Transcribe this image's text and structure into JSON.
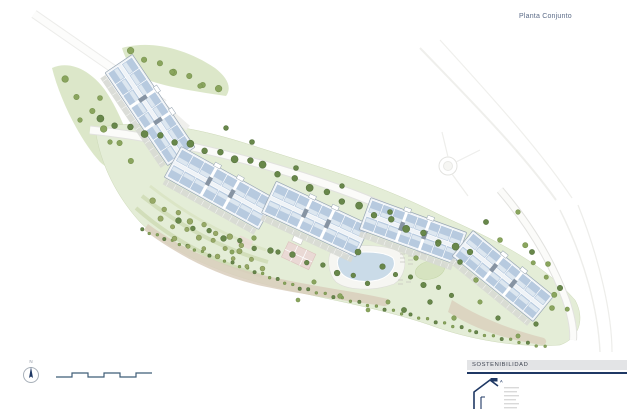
{
  "title": "Planta Conjunto",
  "north": {
    "label": "N"
  },
  "legend": {
    "sustainability": "SOSTENIBILIDAD"
  },
  "colors": {
    "title_text": "#5b6b87",
    "navy": "#1f3864",
    "green_light": "#e4edd7",
    "green_mid": "#d6e3c0",
    "tree_dark": "#68874a",
    "tree_mid": "#8aa55e",
    "tree_light": "#aebf85",
    "olive": "#97a966",
    "road_edge": "#e4e4e1",
    "road_fill": "#fcfcfb",
    "parking": "#d7d9d4",
    "building_base": "#eff3f7",
    "building_unit": "#b7cadf",
    "building_unit_light": "#dde7f0",
    "building_core": "#8794a3",
    "building_stroke": "#98a6b3",
    "pool": "#cadbe8",
    "deck": "#f6f6f2",
    "tan": "#d9cebc",
    "pink": "#ead9d5",
    "scalebar": "#3f5d77",
    "label_gray": "#8b93a0",
    "bar_bg": "#e3e4e6",
    "bar_text": "#3d4350"
  },
  "site_plan": {
    "blocks": [
      {
        "cx": 150,
        "cy": 110,
        "angle": 56,
        "len": 112,
        "wid": 33,
        "units": 8
      },
      {
        "cx": 220,
        "cy": 188,
        "angle": 29,
        "len": 108,
        "wid": 35,
        "units": 8
      },
      {
        "cx": 316,
        "cy": 219,
        "angle": 25,
        "len": 104,
        "wid": 35,
        "units": 8
      },
      {
        "cx": 413,
        "cy": 231,
        "angle": 20,
        "len": 102,
        "wid": 34,
        "units": 8
      },
      {
        "cx": 503,
        "cy": 276,
        "angle": 39,
        "len": 104,
        "wid": 33,
        "units": 8
      }
    ],
    "tree_rows": [
      {
        "x1": 100,
        "y1": 120,
        "x2": 250,
        "y2": 162,
        "n": 11,
        "r": 3.2,
        "color": "tree_dark"
      },
      {
        "x1": 262,
        "y1": 166,
        "x2": 455,
        "y2": 248,
        "n": 13,
        "r": 3.2,
        "color": "tree_dark"
      },
      {
        "x1": 64,
        "y1": 80,
        "x2": 132,
        "y2": 160,
        "n": 6,
        "r": 3,
        "color": "tree_mid"
      },
      {
        "x1": 130,
        "y1": 52,
        "x2": 218,
        "y2": 90,
        "n": 7,
        "r": 3,
        "color": "tree_mid"
      },
      {
        "x1": 142,
        "y1": 230,
        "x2": 300,
        "y2": 288,
        "n": 22,
        "r": 1.5,
        "color": "tree_mid"
      },
      {
        "x1": 308,
        "y1": 290,
        "x2": 470,
        "y2": 330,
        "n": 20,
        "r": 1.5,
        "color": "tree_mid"
      },
      {
        "x1": 476,
        "y1": 333,
        "x2": 545,
        "y2": 347,
        "n": 9,
        "r": 1.5,
        "color": "tree_mid"
      },
      {
        "x1": 152,
        "y1": 202,
        "x2": 242,
        "y2": 244,
        "n": 8,
        "r": 2.6,
        "color": "olive"
      },
      {
        "x1": 160,
        "y1": 220,
        "x2": 252,
        "y2": 258,
        "n": 8,
        "r": 2.4,
        "color": "olive"
      },
      {
        "x1": 174,
        "y1": 240,
        "x2": 262,
        "y2": 270,
        "n": 7,
        "r": 2.2,
        "color": "olive"
      },
      {
        "x1": 178,
        "y1": 222,
        "x2": 270,
        "y2": 252,
        "n": 7,
        "r": 2.6,
        "color": "tree_dark"
      },
      {
        "x1": 292,
        "y1": 256,
        "x2": 368,
        "y2": 282,
        "n": 6,
        "r": 2.6,
        "color": "tree_dark"
      },
      {
        "x1": 382,
        "y1": 268,
        "x2": 452,
        "y2": 294,
        "n": 6,
        "r": 2.5,
        "color": "tree_dark"
      },
      {
        "x1": 524,
        "y1": 246,
        "x2": 566,
        "y2": 310,
        "n": 5,
        "r": 2.4,
        "color": "tree_mid"
      }
    ],
    "trees": [
      [
        358,
        252,
        3,
        "tree_dark"
      ],
      [
        340,
        296,
        2.4,
        "tree_mid"
      ],
      [
        314,
        282,
        2.2,
        "tree_mid"
      ],
      [
        298,
        300,
        2,
        "tree_mid"
      ],
      [
        404,
        310,
        2.6,
        "tree_dark"
      ],
      [
        430,
        302,
        2.4,
        "tree_dark"
      ],
      [
        454,
        318,
        2.3,
        "tree_mid"
      ],
      [
        470,
        252,
        2.8,
        "tree_dark"
      ],
      [
        486,
        222,
        2.6,
        "tree_dark"
      ],
      [
        500,
        240,
        2.5,
        "tree_mid"
      ],
      [
        518,
        212,
        2.3,
        "tree_mid"
      ],
      [
        532,
        252,
        2.6,
        "tree_dark"
      ],
      [
        548,
        264,
        2.5,
        "tree_mid"
      ],
      [
        560,
        288,
        2.7,
        "tree_dark"
      ],
      [
        552,
        308,
        2.5,
        "tree_mid"
      ],
      [
        536,
        324,
        2.3,
        "tree_dark"
      ],
      [
        518,
        336,
        2.1,
        "tree_mid"
      ],
      [
        498,
        318,
        2.3,
        "tree_dark"
      ],
      [
        480,
        302,
        2.2,
        "tree_mid"
      ],
      [
        416,
        258,
        2.3,
        "tree_mid"
      ],
      [
        388,
        302,
        2.1,
        "tree_mid"
      ],
      [
        368,
        310,
        2,
        "tree_mid"
      ],
      [
        278,
        252,
        2.3,
        "tree_dark"
      ],
      [
        254,
        238,
        2.3,
        "tree_mid"
      ],
      [
        232,
        252,
        2.1,
        "tree_mid"
      ],
      [
        100,
        98,
        2.5,
        "tree_mid"
      ],
      [
        80,
        120,
        2.3,
        "tree_mid"
      ],
      [
        110,
        142,
        2.3,
        "tree_mid"
      ],
      [
        172,
        72,
        2.5,
        "tree_mid"
      ],
      [
        200,
        86,
        2.3,
        "tree_mid"
      ],
      [
        252,
        142,
        2.5,
        "tree_dark"
      ],
      [
        226,
        128,
        2.4,
        "tree_dark"
      ],
      [
        296,
        168,
        2.5,
        "tree_dark"
      ],
      [
        342,
        186,
        2.4,
        "tree_dark"
      ],
      [
        390,
        212,
        2.5,
        "tree_dark"
      ],
      [
        438,
        244,
        2.4,
        "tree_dark"
      ],
      [
        460,
        262,
        2.5,
        "tree_dark"
      ],
      [
        476,
        280,
        2.4,
        "tree_mid"
      ]
    ]
  }
}
